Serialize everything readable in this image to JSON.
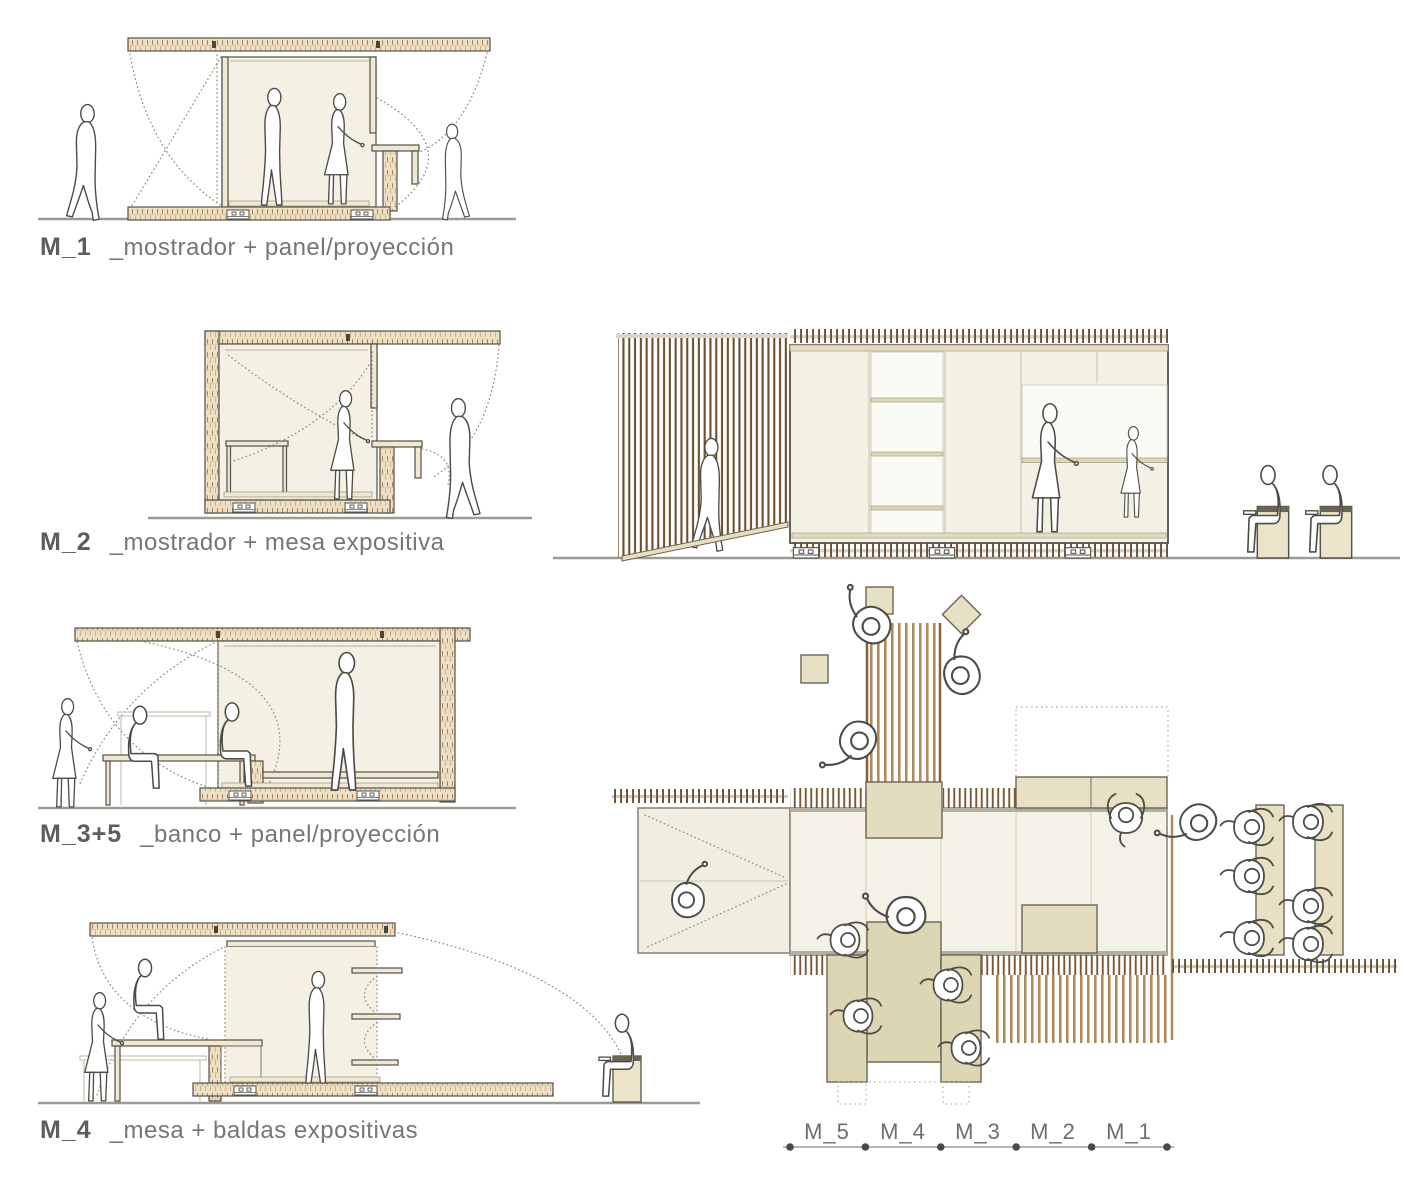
{
  "document": {
    "type": "architectural module diagram sheet",
    "language": "es",
    "views": [
      "section M_1",
      "section M_2",
      "section M_3+5",
      "section M_4",
      "long elevation",
      "floor plan"
    ]
  },
  "sections": [
    {
      "code": "M_1",
      "description": "_mostrador + panel/proyección"
    },
    {
      "code": "M_2",
      "description": "_mostrador + mesa expositiva"
    },
    {
      "code": "M_3+5",
      "description": "_banco + panel/proyección"
    },
    {
      "code": "M_4",
      "description": "_mesa + baldas expositivas"
    }
  ],
  "plan": {
    "scale_labels": [
      "M_5",
      "M_4",
      "M_3",
      "M_2",
      "M_1"
    ]
  },
  "colors": {
    "wood_fill": "#ecdfc4",
    "wood_tick": "#a87c4f",
    "cream_interior": "#f4f1e4",
    "tan_block": "#e2dbba",
    "slat_dark": "#6f4e2d",
    "slat_mid": "#b08a5c",
    "outline": "#55504a",
    "figure_line": "#4d4d47",
    "ghost_line": "#c7c3b5",
    "dotted_line": "#918e80",
    "ground_line": "#9b9b93",
    "text": "#6e6e6e"
  }
}
